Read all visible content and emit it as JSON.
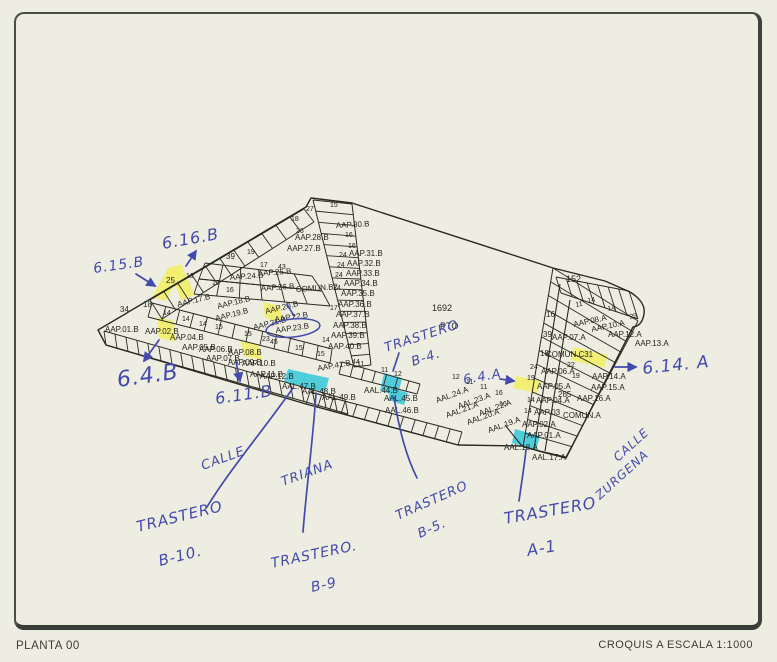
{
  "footer": {
    "left": "PLANTA 00",
    "right": "CROQUIS A ESCALA 1:1000"
  },
  "colors": {
    "paper": "#eeede2",
    "ink": "#2a2a24",
    "yellow": "#f2ee6a",
    "cyan": "#3ec9da",
    "pen": "#4449ae"
  },
  "plan": {
    "outline": "M98,330 L306,207 L311,198 L352,203 L553,268 L605,281 L630,292 Q646,302 644,314 Q642,326 633,327 L566,458 L542,452 L522,446 L458,445 L306,404 L106,345 Z",
    "interior": [
      "M570,300 L545,451",
      "M560,284 L534,449",
      "M505,425 L522,446"
    ],
    "bands": [
      {
        "a": [
          104,
          331
        ],
        "b": [
          345,
          399
        ],
        "c": [
          106,
          345
        ],
        "d": [
          348,
          414
        ],
        "n": 22
      },
      {
        "a": [
          310,
          392
        ],
        "b": [
          462,
          432
        ],
        "c": [
          306,
          404
        ],
        "d": [
          458,
          445
        ],
        "n": 13
      },
      {
        "a": [
          342,
          362
        ],
        "b": [
          420,
          384
        ],
        "c": [
          339,
          374
        ],
        "d": [
          417,
          394
        ],
        "n": 7
      },
      {
        "a": [
          152,
          303
        ],
        "b": [
          332,
          349
        ],
        "c": [
          148,
          317
        ],
        "d": [
          330,
          363
        ],
        "n": 13
      },
      {
        "a": [
          150,
          300
        ],
        "b": [
          304,
          209
        ],
        "c": [
          162,
          319
        ],
        "d": [
          314,
          222
        ],
        "n": 11
      },
      {
        "a": [
          313,
          200
        ],
        "b": [
          354,
          367
        ],
        "c": [
          352,
          204
        ],
        "d": [
          371,
          365
        ],
        "n": 15
      },
      {
        "a": [
          205,
          263
        ],
        "b": [
          312,
          276
        ],
        "c": [
          199,
          279
        ],
        "d": [
          322,
          291
        ],
        "n": 6
      },
      {
        "a": [
          199,
          279
        ],
        "b": [
          322,
          291
        ],
        "c": [
          194,
          294
        ],
        "d": [
          330,
          306
        ],
        "n": 6
      },
      {
        "a": [
          553,
          268
        ],
        "b": [
          523,
          447
        ],
        "c": [
          638,
          321
        ],
        "d": [
          566,
          457
        ],
        "n": 13
      },
      {
        "a": [
          556,
          277
        ],
        "b": [
          629,
          291
        ],
        "c": [
          561,
          293
        ],
        "d": [
          638,
          319
        ],
        "n": 7
      }
    ],
    "highlights": [
      {
        "color": "yellow",
        "pts": "152,297 168,268 181,272 166,301"
      },
      {
        "color": "yellow",
        "pts": "168,268 181,264 195,295 181,300"
      },
      {
        "color": "yellow",
        "pts": "263,302 280,306 282,322 265,318"
      },
      {
        "color": "yellow",
        "pts": "240,340 258,344 262,360 244,356"
      },
      {
        "color": "yellow",
        "pts": "157,317 174,321 176,342 159,338"
      },
      {
        "color": "yellow",
        "pts": "516,376 541,381 537,393 513,388"
      },
      {
        "color": "yellow",
        "pts": "574,347 608,355 604,368 571,360"
      },
      {
        "color": "cyan",
        "pts": "288,369 306,373 302,386 284,382"
      },
      {
        "color": "cyan",
        "pts": "305,373 329,378 325,392 301,387"
      },
      {
        "color": "cyan",
        "pts": "384,373 402,378 398,396 380,391"
      },
      {
        "color": "cyan",
        "pts": "391,388 408,393 404,405 388,400"
      },
      {
        "color": "cyan",
        "pts": "515,429 540,436 536,450 512,443"
      }
    ],
    "labels": [
      {
        "t": "27",
        "x": 306,
        "y": 211,
        "s": 7
      },
      {
        "t": "15",
        "x": 330,
        "y": 207,
        "s": 7
      },
      {
        "t": "18",
        "x": 291,
        "y": 221,
        "s": 7
      },
      {
        "t": "26",
        "x": 296,
        "y": 233,
        "s": 7
      },
      {
        "t": "AAP.30.B",
        "x": 336,
        "y": 228,
        "r": -3
      },
      {
        "t": "16",
        "x": 345,
        "y": 237,
        "s": 7
      },
      {
        "t": "AAP.28.B",
        "x": 295,
        "y": 240
      },
      {
        "t": "16",
        "x": 348,
        "y": 248,
        "s": 7
      },
      {
        "t": "AAP.27.B",
        "x": 287,
        "y": 251
      },
      {
        "t": "24",
        "x": 339,
        "y": 257,
        "s": 7
      },
      {
        "t": "AAP.31.B",
        "x": 349,
        "y": 256
      },
      {
        "t": "24",
        "x": 337,
        "y": 267,
        "s": 7
      },
      {
        "t": "AAP.32.B",
        "x": 347,
        "y": 266
      },
      {
        "t": "24",
        "x": 335,
        "y": 277,
        "s": 7
      },
      {
        "t": "AAP.33.B",
        "x": 346,
        "y": 276
      },
      {
        "t": "AAP.34.B",
        "x": 344,
        "y": 286
      },
      {
        "t": "24",
        "x": 333,
        "y": 290,
        "s": 7
      },
      {
        "t": "AAP.35.B",
        "x": 341,
        "y": 296
      },
      {
        "t": "AAP.36.B",
        "x": 338,
        "y": 307
      },
      {
        "t": "17",
        "x": 330,
        "y": 310,
        "s": 7
      },
      {
        "t": "AAP.37.B",
        "x": 336,
        "y": 317
      },
      {
        "t": "AAP.38.B",
        "x": 333,
        "y": 328
      },
      {
        "t": "AAP.39.B",
        "x": 331,
        "y": 338
      },
      {
        "t": "14",
        "x": 322,
        "y": 342,
        "s": 7
      },
      {
        "t": "AAP.40.B",
        "x": 328,
        "y": 349
      },
      {
        "t": "AAP.41.B",
        "x": 318,
        "y": 371,
        "r": -10
      },
      {
        "t": "11",
        "x": 357,
        "y": 366,
        "s": 7
      },
      {
        "t": "11",
        "x": 381,
        "y": 372,
        "s": 7
      },
      {
        "t": "12",
        "x": 394,
        "y": 376,
        "s": 7
      },
      {
        "t": "39",
        "x": 226,
        "y": 259
      },
      {
        "t": "19",
        "x": 247,
        "y": 254,
        "s": 7
      },
      {
        "t": "17",
        "x": 260,
        "y": 267,
        "s": 7
      },
      {
        "t": "43",
        "x": 278,
        "y": 269,
        "s": 7
      },
      {
        "t": "AAP.24.B",
        "x": 230,
        "y": 280,
        "r": -4
      },
      {
        "t": "AAP.25.B",
        "x": 258,
        "y": 276,
        "r": -4
      },
      {
        "t": "AAP.26.B",
        "x": 261,
        "y": 291,
        "r": -4
      },
      {
        "t": "COMUN.B2",
        "x": 296,
        "y": 292,
        "r": -4
      },
      {
        "t": "25",
        "x": 166,
        "y": 283
      },
      {
        "t": "16",
        "x": 186,
        "y": 278,
        "s": 7
      },
      {
        "t": "17",
        "x": 212,
        "y": 285,
        "s": 7
      },
      {
        "t": "16",
        "x": 226,
        "y": 292,
        "s": 7
      },
      {
        "t": "AAP.17.B",
        "x": 178,
        "y": 307,
        "r": -14
      },
      {
        "t": "AAP.18.B",
        "x": 218,
        "y": 309,
        "r": -14
      },
      {
        "t": "AAP.19.B",
        "x": 216,
        "y": 321,
        "r": -14
      },
      {
        "t": "AAP.20.B",
        "x": 266,
        "y": 314,
        "r": -14
      },
      {
        "t": "AAP.21.B",
        "x": 254,
        "y": 330,
        "r": -14
      },
      {
        "t": "AAP.22.B",
        "x": 275,
        "y": 322,
        "r": -8
      },
      {
        "t": "AAP.23.B",
        "x": 276,
        "y": 333,
        "r": -8
      },
      {
        "t": "34",
        "x": 120,
        "y": 312
      },
      {
        "t": "18",
        "x": 143,
        "y": 307
      },
      {
        "t": "14",
        "x": 163,
        "y": 315,
        "s": 7
      },
      {
        "t": "14",
        "x": 182,
        "y": 321,
        "s": 7
      },
      {
        "t": "14",
        "x": 199,
        "y": 326,
        "s": 7
      },
      {
        "t": "15",
        "x": 215,
        "y": 329,
        "s": 7
      },
      {
        "t": "15",
        "x": 244,
        "y": 336,
        "s": 7
      },
      {
        "t": "23",
        "x": 262,
        "y": 341,
        "s": 7
      },
      {
        "t": "45",
        "x": 270,
        "y": 344,
        "s": 7
      },
      {
        "t": "15",
        "x": 295,
        "y": 350,
        "s": 7
      },
      {
        "t": "15",
        "x": 317,
        "y": 356,
        "s": 7
      },
      {
        "t": "44",
        "x": 352,
        "y": 364,
        "s": 7
      },
      {
        "t": "AAP.01.B",
        "x": 105,
        "y": 332
      },
      {
        "t": "AAP.02.B",
        "x": 145,
        "y": 334
      },
      {
        "t": "AAP.04.B",
        "x": 170,
        "y": 340
      },
      {
        "t": "AAP.05.B",
        "x": 182,
        "y": 350
      },
      {
        "t": "AAP.06.B",
        "x": 199,
        "y": 352
      },
      {
        "t": "AAP.07.B",
        "x": 206,
        "y": 361
      },
      {
        "t": "AAP.08.B",
        "x": 228,
        "y": 355
      },
      {
        "t": "AAP.09.B",
        "x": 228,
        "y": 365
      },
      {
        "t": "AAP.10.B",
        "x": 242,
        "y": 366
      },
      {
        "t": "AAP.11.B",
        "x": 250,
        "y": 377
      },
      {
        "t": "AAP.12.B",
        "x": 260,
        "y": 379
      },
      {
        "t": "AAL.47.B",
        "x": 282,
        "y": 389
      },
      {
        "t": "AAL.48.B",
        "x": 302,
        "y": 394
      },
      {
        "t": "AAL.49.B",
        "x": 322,
        "y": 400
      },
      {
        "t": "AAL.44.B",
        "x": 364,
        "y": 393
      },
      {
        "t": "AAL.45.B",
        "x": 384,
        "y": 401
      },
      {
        "t": "AAL.46.B",
        "x": 385,
        "y": 413
      },
      {
        "t": "AAL.24.A",
        "x": 437,
        "y": 403,
        "r": -20
      },
      {
        "t": "AAL.23.A",
        "x": 459,
        "y": 409,
        "r": -20
      },
      {
        "t": "AAL.22.A",
        "x": 480,
        "y": 416,
        "r": -20
      },
      {
        "t": "AAL.21.A",
        "x": 447,
        "y": 418,
        "r": -20
      },
      {
        "t": "AAL.20.A",
        "x": 468,
        "y": 425,
        "r": -20
      },
      {
        "t": "AAL.19.A",
        "x": 489,
        "y": 433,
        "r": -20
      },
      {
        "t": "AAL.18.A",
        "x": 504,
        "y": 450
      },
      {
        "t": "AAL.17.A",
        "x": 532,
        "y": 460
      },
      {
        "t": "152",
        "x": 566,
        "y": 282,
        "s": 9
      },
      {
        "t": "14",
        "x": 588,
        "y": 303,
        "s": 7,
        "r": -12
      },
      {
        "t": "14",
        "x": 608,
        "y": 311,
        "s": 7,
        "r": -12
      },
      {
        "t": "11",
        "x": 576,
        "y": 307,
        "s": 7,
        "r": -12
      },
      {
        "t": "29",
        "x": 630,
        "y": 319,
        "s": 7,
        "r": -12
      },
      {
        "t": "16",
        "x": 546,
        "y": 317
      },
      {
        "t": "39",
        "x": 543,
        "y": 337
      },
      {
        "t": "AAP.07.A",
        "x": 552,
        "y": 340
      },
      {
        "t": "AAP.08.A",
        "x": 574,
        "y": 327,
        "r": -12
      },
      {
        "t": "AAP.10.A",
        "x": 592,
        "y": 332,
        "r": -12
      },
      {
        "t": "AAP.12.A",
        "x": 608,
        "y": 337
      },
      {
        "t": "AAP.13.A",
        "x": 635,
        "y": 346
      },
      {
        "t": "18",
        "x": 540,
        "y": 356
      },
      {
        "t": "COMUN.C31",
        "x": 546,
        "y": 357
      },
      {
        "t": "22",
        "x": 567,
        "y": 367,
        "s": 7
      },
      {
        "t": "AAP.06.A",
        "x": 541,
        "y": 374
      },
      {
        "t": "19",
        "x": 572,
        "y": 378,
        "s": 7
      },
      {
        "t": "AAP.14.A",
        "x": 592,
        "y": 379
      },
      {
        "t": "24",
        "x": 530,
        "y": 369,
        "s": 7
      },
      {
        "t": "19",
        "x": 527,
        "y": 380,
        "s": 7
      },
      {
        "t": "AAP.05.A",
        "x": 537,
        "y": 389
      },
      {
        "t": "265",
        "x": 558,
        "y": 397
      },
      {
        "t": "AAP.15.A",
        "x": 591,
        "y": 390
      },
      {
        "t": "14",
        "x": 527,
        "y": 402,
        "s": 7
      },
      {
        "t": "AAP.04.A",
        "x": 536,
        "y": 403
      },
      {
        "t": "AAP.16.A",
        "x": 577,
        "y": 401
      },
      {
        "t": "14",
        "x": 524,
        "y": 413,
        "s": 7
      },
      {
        "t": "AAP.03",
        "x": 534,
        "y": 415
      },
      {
        "t": "COMUN.A",
        "x": 563,
        "y": 418
      },
      {
        "t": "16",
        "x": 499,
        "y": 406,
        "s": 7
      },
      {
        "t": "AAP.02.A",
        "x": 522,
        "y": 427
      },
      {
        "t": "AAP.01.A",
        "x": 527,
        "y": 438
      },
      {
        "t": "12",
        "x": 452,
        "y": 379,
        "s": 7
      },
      {
        "t": "11",
        "x": 466,
        "y": 384,
        "s": 7
      },
      {
        "t": "11",
        "x": 480,
        "y": 389,
        "s": 7
      },
      {
        "t": "16",
        "x": 495,
        "y": 395,
        "s": 7
      },
      {
        "t": "1692",
        "x": 432,
        "y": 311,
        "s": 9
      },
      {
        "t": "PTO",
        "x": 440,
        "y": 329,
        "s": 9
      }
    ],
    "handwriting": [
      {
        "t": "6.16.B",
        "x": 163,
        "y": 249,
        "r": -10,
        "s": 16
      },
      {
        "t": "6.15.B",
        "x": 94,
        "y": 273,
        "r": -8,
        "s": 14
      },
      {
        "t": "6.4.B",
        "x": 118,
        "y": 387,
        "r": -8,
        "s": 22
      },
      {
        "t": "6.11.B",
        "x": 216,
        "y": 404,
        "r": -8,
        "s": 16
      },
      {
        "t": "TRASTERO",
        "x": 386,
        "y": 352,
        "r": -18,
        "s": 13
      },
      {
        "t": "B-4.",
        "x": 413,
        "y": 366,
        "r": -18,
        "s": 13
      },
      {
        "t": "6.4.A",
        "x": 464,
        "y": 384,
        "r": -10,
        "s": 13
      },
      {
        "t": "6.14. A",
        "x": 643,
        "y": 374,
        "r": -6,
        "s": 17
      },
      {
        "t": "CALLE",
        "x": 203,
        "y": 470,
        "r": -20,
        "s": 13
      },
      {
        "t": "TRIANA",
        "x": 283,
        "y": 486,
        "r": -20,
        "s": 13
      },
      {
        "t": "TRASTERO",
        "x": 138,
        "y": 532,
        "r": -14,
        "s": 15
      },
      {
        "t": "B-10.",
        "x": 160,
        "y": 566,
        "r": -14,
        "s": 15
      },
      {
        "t": "TRASTERO.",
        "x": 272,
        "y": 568,
        "r": -12,
        "s": 14
      },
      {
        "t": "B-9",
        "x": 312,
        "y": 592,
        "r": -12,
        "s": 14
      },
      {
        "t": "TRASTERO",
        "x": 398,
        "y": 520,
        "r": -24,
        "s": 13
      },
      {
        "t": "B-5.",
        "x": 420,
        "y": 538,
        "r": -24,
        "s": 13
      },
      {
        "t": "TRASTERO",
        "x": 505,
        "y": 524,
        "r": -10,
        "s": 16
      },
      {
        "t": "A-1",
        "x": 528,
        "y": 556,
        "r": -10,
        "s": 16
      },
      {
        "t": "CALLE",
        "x": 618,
        "y": 462,
        "r": -42,
        "s": 12
      },
      {
        "t": "ZURGENA",
        "x": 600,
        "y": 500,
        "r": -42,
        "s": 12
      }
    ],
    "pen_lines": [
      {
        "d": "M186,266 L196,251",
        "arrow": true
      },
      {
        "d": "M136,274 L155,286",
        "arrow": true
      },
      {
        "d": "M159,340 L144,361",
        "arrow": true
      },
      {
        "d": "M236,362 L240,381",
        "arrow": true
      },
      {
        "d": "M500,379 L514,381",
        "arrow": true
      },
      {
        "d": "M615,367 L636,367",
        "arrow": true
      },
      {
        "d": "M293,388 C265,428 228,472 207,507",
        "arrow": false
      },
      {
        "d": "M316,393 C313,440 306,492 303,532",
        "arrow": false
      },
      {
        "d": "M394,397 C399,430 407,458 417,478",
        "arrow": false
      },
      {
        "d": "M526,450 C524,468 521,486 519,501",
        "arrow": false
      },
      {
        "d": "M399,353 L393,371",
        "arrow": false
      },
      {
        "d": "M287,304 L294,316",
        "arrow": false
      }
    ],
    "pen_ellipse": {
      "cx": 293,
      "cy": 328,
      "rx": 27,
      "ry": 9,
      "r": -6
    }
  }
}
